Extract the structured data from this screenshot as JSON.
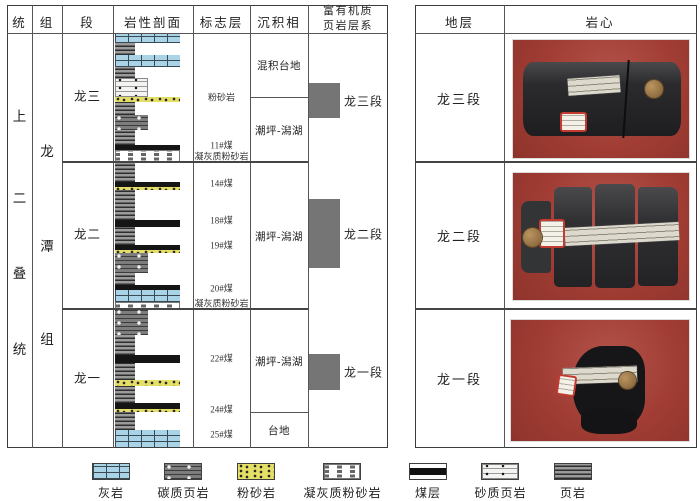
{
  "left_table": {
    "headers": [
      "统",
      "组",
      "段",
      "岩性剖面",
      "标志层",
      "沉积相",
      "富有机质页岩层系"
    ],
    "system_label": {
      "text": "上二叠统",
      "chars": [
        {
          "ch": "上",
          "y": 115
        },
        {
          "ch": "二",
          "y": 197
        },
        {
          "ch": "叠",
          "y": 272
        },
        {
          "ch": "统",
          "y": 348
        }
      ]
    },
    "formation_label": {
      "text": "龙潭组",
      "chars": [
        {
          "ch": "龙",
          "y": 150
        },
        {
          "ch": "潭",
          "y": 245
        },
        {
          "ch": "组",
          "y": 338
        }
      ]
    },
    "members": [
      {
        "label": "龙三",
        "y": 95
      },
      {
        "label": "龙二",
        "y": 233
      },
      {
        "label": "龙一",
        "y": 377
      }
    ],
    "lithology_layers": [
      {
        "pattern": "limestone",
        "top": 33,
        "height": 10,
        "width": "wide"
      },
      {
        "pattern": "shale",
        "top": 43,
        "height": 12,
        "width": "narrow"
      },
      {
        "pattern": "limestone",
        "top": 55,
        "height": 12,
        "width": "wide"
      },
      {
        "pattern": "shale",
        "top": 67,
        "height": 11,
        "width": "narrow"
      },
      {
        "pattern": "sandyshale",
        "top": 78,
        "height": 19,
        "width": "medium"
      },
      {
        "pattern": "siltstone",
        "top": 97,
        "height": 5,
        "width": "wide"
      },
      {
        "pattern": "shale",
        "top": 102,
        "height": 13,
        "width": "narrow"
      },
      {
        "pattern": "carbshale",
        "top": 115,
        "height": 15,
        "width": "medium"
      },
      {
        "pattern": "shale",
        "top": 130,
        "height": 15,
        "width": "narrow"
      },
      {
        "pattern": "coal",
        "top": 145,
        "height": 5,
        "width": "wide"
      },
      {
        "pattern": "tuffsilt",
        "top": 150,
        "height": 12,
        "width": "wide"
      },
      {
        "pattern": "shale",
        "top": 162,
        "height": 20,
        "width": "narrow"
      },
      {
        "pattern": "coal",
        "top": 182,
        "height": 5,
        "width": "wide"
      },
      {
        "pattern": "siltstone",
        "top": 187,
        "height": 3,
        "width": "wide"
      },
      {
        "pattern": "shale",
        "top": 190,
        "height": 30,
        "width": "narrow"
      },
      {
        "pattern": "coal",
        "top": 220,
        "height": 7,
        "width": "wide"
      },
      {
        "pattern": "shale",
        "top": 227,
        "height": 18,
        "width": "narrow"
      },
      {
        "pattern": "coal",
        "top": 245,
        "height": 5,
        "width": "wide"
      },
      {
        "pattern": "siltstone",
        "top": 250,
        "height": 3,
        "width": "wide"
      },
      {
        "pattern": "carbshale",
        "top": 253,
        "height": 20,
        "width": "medium"
      },
      {
        "pattern": "shale",
        "top": 273,
        "height": 12,
        "width": "narrow"
      },
      {
        "pattern": "coal",
        "top": 285,
        "height": 5,
        "width": "wide"
      },
      {
        "pattern": "limestone",
        "top": 290,
        "height": 12,
        "width": "wide"
      },
      {
        "pattern": "tuffsilt",
        "top": 302,
        "height": 7,
        "width": "wide"
      },
      {
        "pattern": "carbshale",
        "top": 309,
        "height": 26,
        "width": "medium"
      },
      {
        "pattern": "shale",
        "top": 335,
        "height": 20,
        "width": "narrow"
      },
      {
        "pattern": "coal",
        "top": 355,
        "height": 8,
        "width": "wide"
      },
      {
        "pattern": "shale",
        "top": 363,
        "height": 17,
        "width": "narrow"
      },
      {
        "pattern": "siltstone",
        "top": 380,
        "height": 6,
        "width": "wide"
      },
      {
        "pattern": "shale",
        "top": 386,
        "height": 17,
        "width": "narrow"
      },
      {
        "pattern": "coal",
        "top": 403,
        "height": 6,
        "width": "wide"
      },
      {
        "pattern": "siltstone",
        "top": 409,
        "height": 3,
        "width": "wide"
      },
      {
        "pattern": "shale",
        "top": 412,
        "height": 18,
        "width": "narrow"
      },
      {
        "pattern": "limestone",
        "top": 430,
        "height": 18,
        "width": "wide"
      }
    ],
    "markers": [
      {
        "label": "粉砂岩",
        "y": 97
      },
      {
        "label": "11#煤",
        "y": 145
      },
      {
        "label": "凝灰质粉砂岩",
        "y": 156
      },
      {
        "label": "14#煤",
        "y": 183
      },
      {
        "label": "18#煤",
        "y": 220
      },
      {
        "label": "19#煤",
        "y": 245
      },
      {
        "label": "20#煤",
        "y": 288
      },
      {
        "label": "凝灰质粉砂岩",
        "y": 303
      },
      {
        "label": "22#煤",
        "y": 358
      },
      {
        "label": "24#煤",
        "y": 409
      },
      {
        "label": "25#煤",
        "y": 434
      }
    ],
    "facies": [
      {
        "label": "混积台地",
        "top": 33,
        "bottom": 97
      },
      {
        "label": "潮坪-潟湖",
        "top": 97,
        "bottom": 162
      },
      {
        "label": "潮坪-潟湖",
        "top": 162,
        "bottom": 309
      },
      {
        "label": "潮坪-潟湖",
        "top": 309,
        "bottom": 412
      },
      {
        "label": "台地",
        "top": 412,
        "bottom": 448
      }
    ],
    "shale_systems": [
      {
        "label": "龙三段",
        "top": 83,
        "bottom": 118
      },
      {
        "label": "龙二段",
        "top": 199,
        "bottom": 268
      },
      {
        "label": "龙一段",
        "top": 354,
        "bottom": 390
      }
    ]
  },
  "right_table": {
    "headers": [
      "地层",
      "岩心"
    ],
    "rows": [
      {
        "strata": "龙三段",
        "photo": "core-photo-long3"
      },
      {
        "strata": "龙二段",
        "photo": "core-photo-long2"
      },
      {
        "strata": "龙一段",
        "photo": "core-photo-long1"
      }
    ]
  },
  "legend": [
    {
      "pattern": "limestone",
      "label": "灰岩"
    },
    {
      "pattern": "carbshale",
      "label": "碳质页岩"
    },
    {
      "pattern": "siltstone",
      "label": "粉砂岩"
    },
    {
      "pattern": "tuffsilt",
      "label": "凝灰质粉砂岩"
    },
    {
      "pattern": "coal",
      "label": "煤层"
    },
    {
      "pattern": "sandyshale",
      "label": "砂质页岩"
    },
    {
      "pattern": "shale",
      "label": "页岩"
    }
  ],
  "colors": {
    "limestone": "#a9d4e8",
    "siltstone": "#e5df66",
    "coal": "#151515",
    "shale_system_bar": "#757575",
    "photo_background": "#a03c33"
  }
}
